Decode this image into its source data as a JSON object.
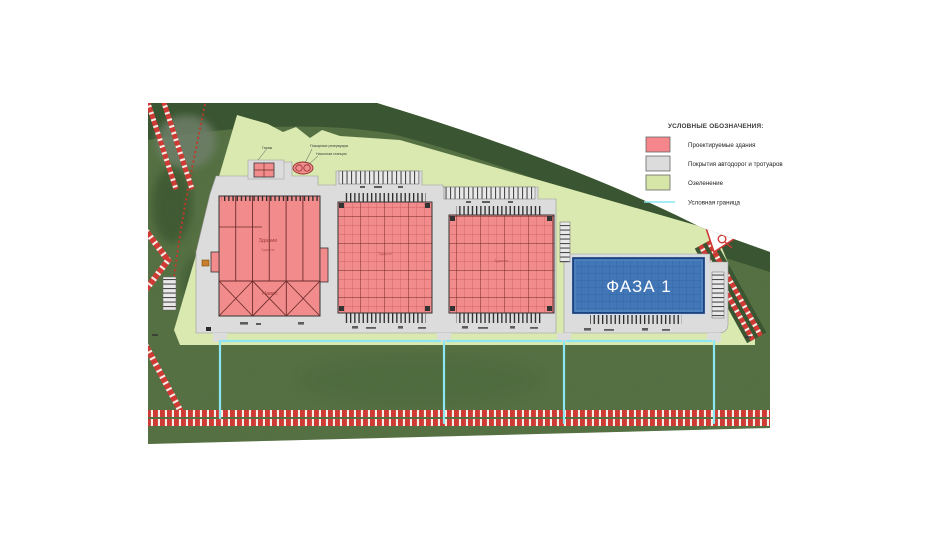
{
  "legend": {
    "title": "УСЛОВНЫЕ ОБОЗНАЧЕНИЯ:",
    "items": [
      {
        "id": "buildings",
        "label": "Проектируемые здания",
        "swatch": "#f5868c"
      },
      {
        "id": "roads",
        "label": "Покрытия автодорог и тротуаров",
        "swatch": "#dcdcdc"
      },
      {
        "id": "greenery",
        "label": "Озеленение",
        "swatch": "#d5e6a7"
      },
      {
        "id": "boundary",
        "label": "Условная граница",
        "swatch": "#8ce7f2"
      }
    ]
  },
  "plan": {
    "phase1": "ФАЗА 1",
    "building_main": "Здание",
    "building_canopy": "Навес",
    "note_garage": "Гараж",
    "note_tanks": "Пожарные резервуары",
    "note_pump": "Насосная станция"
  },
  "colors": {
    "building_fill": "#f28b8b",
    "pavement": "#dcdcdc",
    "greenery": "#d9e9af",
    "boundary_line": "#8ce7f2",
    "phase1_fill": "#4377b7",
    "grass_dark": "#55713f",
    "forest": "#3a5531",
    "stripe_red": "#cf3a34"
  }
}
